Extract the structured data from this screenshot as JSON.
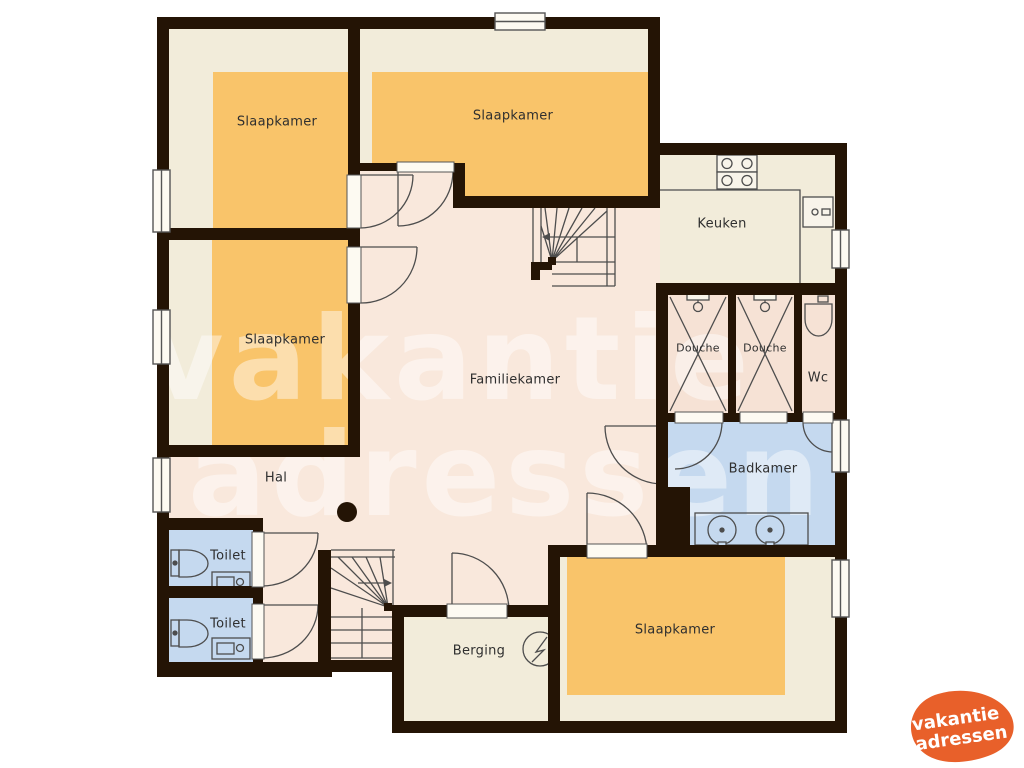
{
  "rooms": {
    "slaapkamer1": {
      "label": "Slaapkamer"
    },
    "slaapkamer2": {
      "label": "Slaapkamer"
    },
    "slaapkamer3": {
      "label": "Slaapkamer"
    },
    "slaapkamer4": {
      "label": "Slaapkamer"
    },
    "keuken": {
      "label": "Keuken"
    },
    "familiekamer": {
      "label": "Familiekamer"
    },
    "hal": {
      "label": "Hal"
    },
    "douche1": {
      "label": "Douche"
    },
    "douche2": {
      "label": "Douche"
    },
    "wc": {
      "label": "Wc"
    },
    "badkamer": {
      "label": "Badkamer"
    },
    "toilet1": {
      "label": "Toilet"
    },
    "toilet2": {
      "label": "Toilet"
    },
    "berging": {
      "label": "Berging"
    }
  },
  "watermark": {
    "line1": "vakantie",
    "line2": "adressen"
  },
  "logo": {
    "line1": "vakantie",
    "line2": "adressen"
  },
  "colors": {
    "wall": "#241405",
    "floor_pink": "#f9e8dc",
    "floor_beige": "#f2ecda",
    "room_orange": "#f9c46a",
    "wet_blue": "#c5d9ef",
    "shower_floor": "#f6e2d5",
    "logo_orange": "#e8602a",
    "linework": "#4d4d4d"
  }
}
